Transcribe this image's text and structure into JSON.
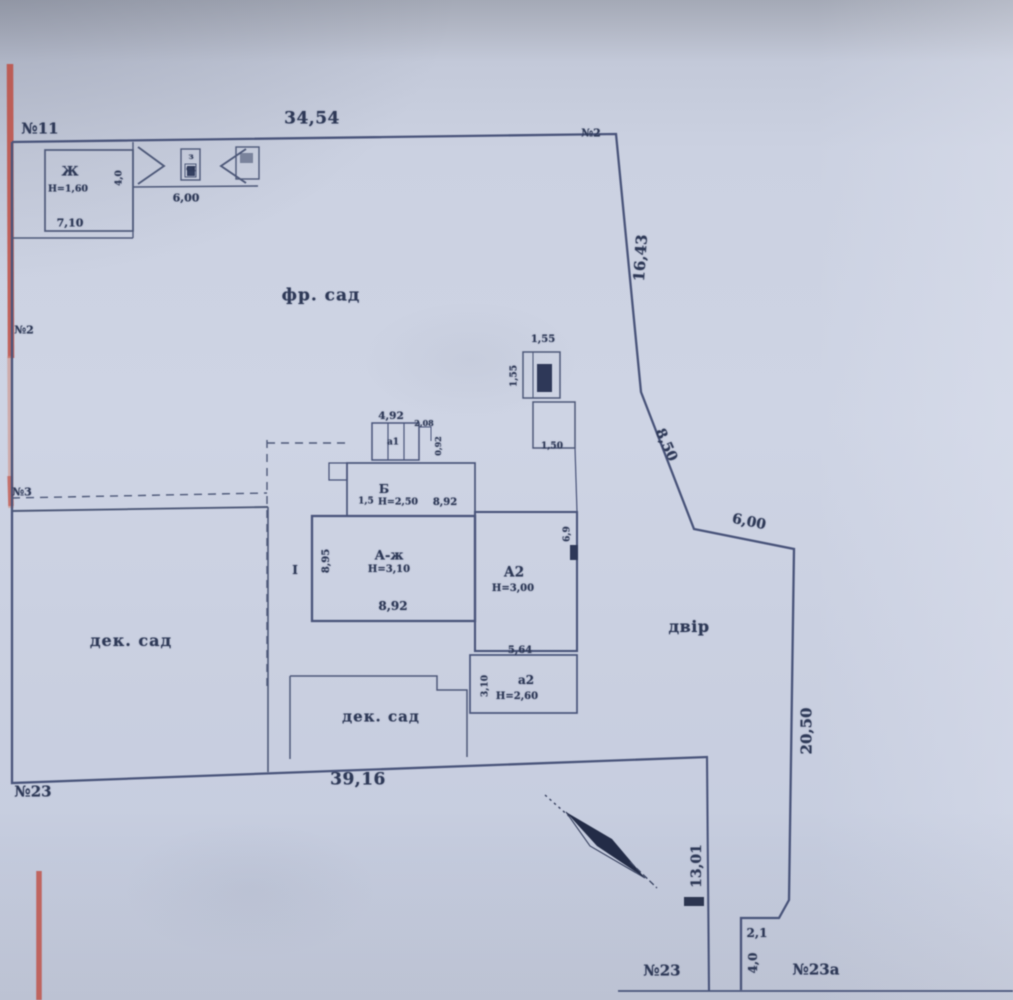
{
  "plan": {
    "neighbors": {
      "top_left": "№11",
      "top_right": "№2",
      "left_upper": "№2",
      "left_lower": "№3",
      "bottom_left": "№23",
      "street_left": "№23",
      "street_right": "№23а"
    },
    "areas": {
      "front_garden": "фр. сад",
      "left_garden": "дек. сад",
      "middle_garden": "дек. сад",
      "yard": "двір"
    },
    "boundary": {
      "top": "34,54",
      "right_upper": "16,43",
      "right_diagonal": "8,50",
      "right_middle": "6,00",
      "right_lower": "20,50",
      "bottom": "39,16",
      "driveway": "13,01",
      "notch_width": "2,1",
      "notch_depth": "4,0"
    },
    "shed": {
      "label": "Ж",
      "height": "Н=1,60",
      "width": "7,10",
      "depth": "4,0"
    },
    "gate": {
      "width": "6,00",
      "post_top": "з",
      "post_bottom": "сх"
    },
    "house": {
      "porch_width": "4,92",
      "porch_label": "а1",
      "porch_step_width": "2,08",
      "porch_step_depth": "0,92",
      "veranda_label": "Б",
      "veranda_height": "Н=2,50",
      "veranda_width": "8,92",
      "veranda_left": "1,5",
      "main_label": "А-ж",
      "main_height": "Н=3,10",
      "main_width": "8,92",
      "main_depth": "8,95",
      "section": "І"
    },
    "annex": {
      "label": "А2",
      "height": "Н=3,00",
      "width": "5,64",
      "depth": "6,9"
    },
    "summer_kitchen": {
      "label": "а2",
      "height": "Н=2,60",
      "depth": "3,10"
    },
    "well": {
      "width": "1,55",
      "depth": "1,55",
      "lower_width": "1,50"
    }
  }
}
